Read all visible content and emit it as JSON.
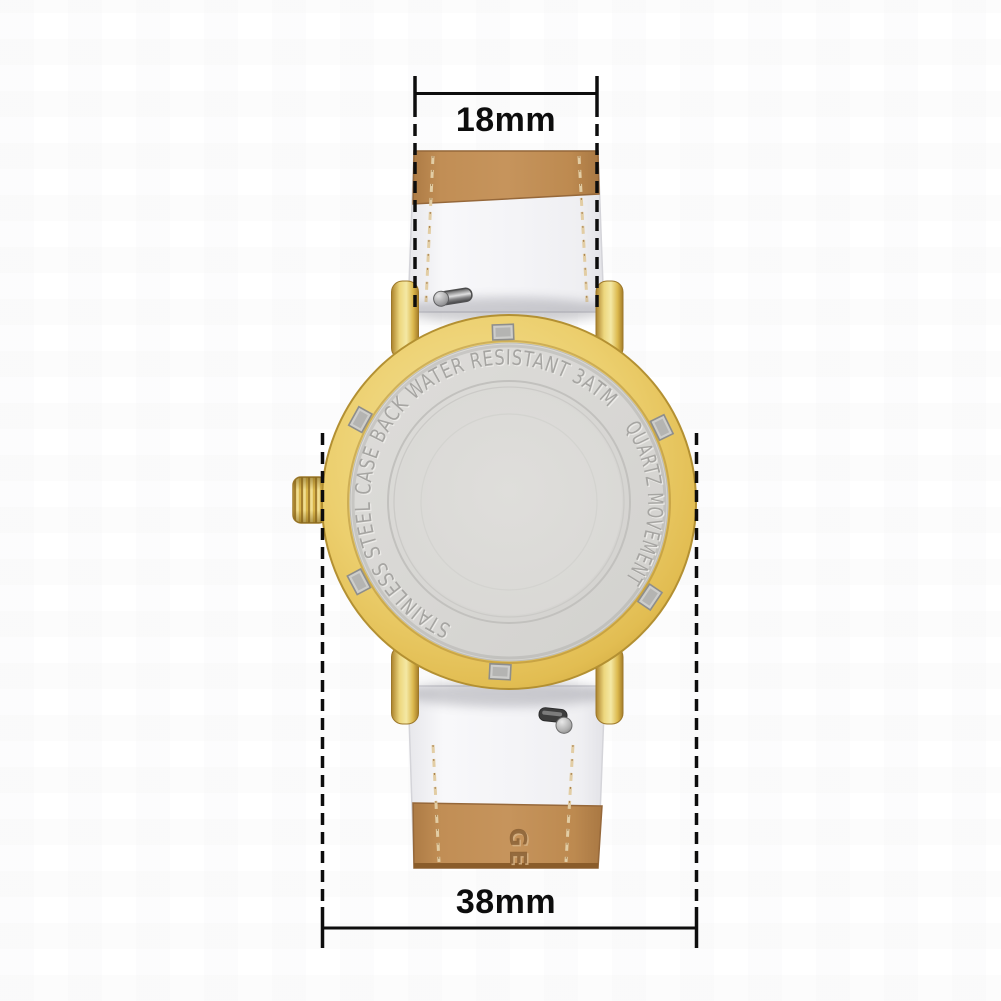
{
  "image": {
    "description": "Product photo: back view of a gold round quartz watch with two-tone leather strap (tan suede outside, white lining) and dimension annotations"
  },
  "annotations": {
    "lug_width": "18mm",
    "case_width": "38mm"
  },
  "caseback": {
    "engraving_left": "STAINLESS STEEL CASE BACK",
    "engraving_top": "WATER RESISTANT 3ATM",
    "engraving_right": "QUARTZ MOVEMENT"
  },
  "strap": {
    "brand_embossed": "GE"
  },
  "colors": {
    "gold": "#e8ca62",
    "gold_edge": "#b39032",
    "steel_back": "#d8d7d4",
    "engraving": "#a6a5a2",
    "strap_suede": "#bd8a50",
    "strap_lining": "#f5f5f7",
    "stitching": "#e2cda4",
    "annotation": "#0d0d0d",
    "background": "#ffffff"
  }
}
